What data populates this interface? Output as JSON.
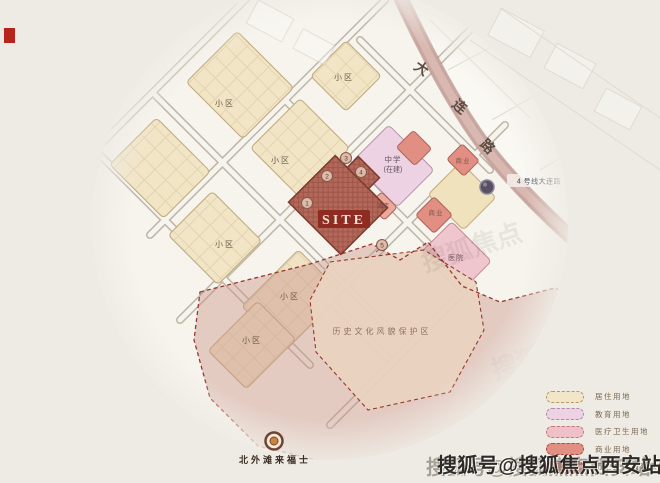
{
  "canvas": {
    "width": 660,
    "height": 483,
    "background": "#eeebe4"
  },
  "map": {
    "residential_label": "小区",
    "school_label_line1": "中学",
    "school_label_line2": "(在建)",
    "hospital_label": "医院",
    "commercial_label": "商业",
    "hotel_label": "酒店",
    "site_label": "SITE",
    "site_markers": [
      "1",
      "2",
      "3",
      "4",
      "5"
    ],
    "heritage_zone_label": "历史文化风貌保护区",
    "main_road_name": "大连路",
    "main_road_char_1": "大",
    "main_road_char_2": "连",
    "main_road_char_3": "路",
    "metro_station_label": "4 号线大连路",
    "landmark_label": "北外滩来福士"
  },
  "legend": {
    "items": [
      {
        "label": "居住用地",
        "color": "#f3e6c8",
        "border": "#b09a6a"
      },
      {
        "label": "教育用地",
        "color": "#ecd2e2",
        "border": "#b088a8"
      },
      {
        "label": "医疗卫生用地",
        "color": "#efc0c8",
        "border": "#c07880"
      },
      {
        "label": "商业用地",
        "color": "#e08f82",
        "border": "#a85048"
      },
      {
        "label": "历史文化风貌保护区",
        "color": "#dfa49c",
        "border": "#a85048"
      }
    ]
  },
  "watermark": {
    "text": "搜狐号@搜狐焦点西安站",
    "ghost_text": "搜狐焦点"
  },
  "colors": {
    "site_fill": "#b2685a",
    "site_tag": "#8e2c21",
    "main_road": "#c9a5a0",
    "heritage_wash": "#c79288",
    "protection_border": "#96382c",
    "residential": "#f2e5c6",
    "education": "#ecd2e2",
    "medical": "#efc6cd",
    "commercial": "#e08f82"
  }
}
